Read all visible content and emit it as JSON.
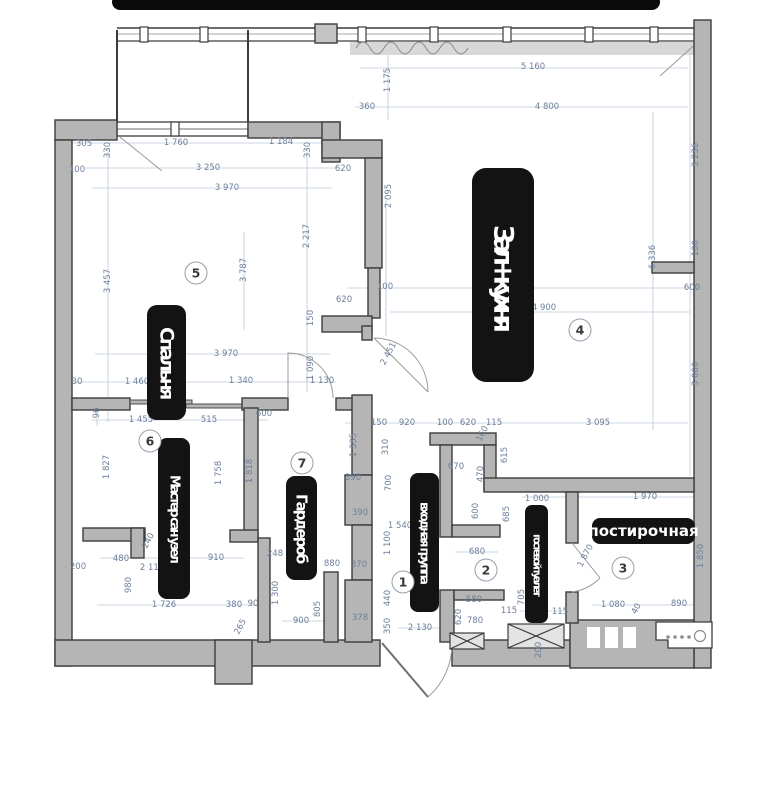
{
  "colors": {
    "wall_fill": "#b5b5b5",
    "wall_stroke": "#3c3c3c",
    "dim_text": "#6d7f9b",
    "dim_line": "#bcc6da",
    "label_bg": "#131313",
    "label_fg": "#ffffff",
    "sill_band": "#d8d8d8"
  },
  "plan": {
    "rooms": [
      {
        "number": "1",
        "name": "входная группа"
      },
      {
        "number": "2",
        "name": "гостевой туалет"
      },
      {
        "number": "3",
        "name": "постирочная"
      },
      {
        "number": "4",
        "name": "Зал + кухня"
      },
      {
        "number": "5",
        "name": "Спальня"
      },
      {
        "number": "6",
        "name": "Мастер сан узел"
      },
      {
        "number": "7",
        "name": "Гардероб"
      }
    ],
    "labels": [
      {
        "text": "Спальня",
        "x": 147,
        "y": 305,
        "w": 39,
        "h": 115,
        "vert": true,
        "size": 19,
        "ls": -3,
        "radius": 10
      },
      {
        "text": "Мастер сан узел",
        "x": 158,
        "y": 438,
        "w": 32,
        "h": 161,
        "vert": true,
        "size": 13,
        "ls": -2.5,
        "radius": 9
      },
      {
        "text": "Гардероб",
        "x": 286,
        "y": 476,
        "w": 31,
        "h": 104,
        "vert": true,
        "size": 15,
        "ls": -2,
        "radius": 9
      },
      {
        "text": "Зал + кухня",
        "x": 472,
        "y": 168,
        "w": 62,
        "h": 214,
        "vert": true,
        "size": 27,
        "ls": -8,
        "radius": 14
      },
      {
        "text": "входная группа",
        "x": 410,
        "y": 473,
        "w": 29,
        "h": 139,
        "vert": true,
        "size": 12,
        "ls": -2,
        "radius": 8
      },
      {
        "text": "гостевой туалет",
        "x": 525,
        "y": 505,
        "w": 23,
        "h": 118,
        "vert": true,
        "size": 10.5,
        "ls": -2.5,
        "radius": 7
      },
      {
        "text": "постирочная",
        "x": 592,
        "y": 518,
        "w": 103,
        "h": 26,
        "vert": false,
        "size": 15,
        "ls": 0,
        "radius": 8
      }
    ],
    "markers": [
      {
        "n": "1",
        "x": 403,
        "y": 582
      },
      {
        "n": "2",
        "x": 486,
        "y": 570
      },
      {
        "n": "3",
        "x": 623,
        "y": 568
      },
      {
        "n": "4",
        "x": 580,
        "y": 330
      },
      {
        "n": "5",
        "x": 196,
        "y": 273
      },
      {
        "n": "6",
        "x": 150,
        "y": 441
      },
      {
        "n": "7",
        "x": 302,
        "y": 463
      }
    ],
    "dimensions": [
      {
        "t": "5 160",
        "x": 533,
        "y": 67,
        "r": "h"
      },
      {
        "t": "1 175",
        "x": 388,
        "y": 80,
        "r": "v"
      },
      {
        "t": "360",
        "x": 367,
        "y": 107,
        "r": "h"
      },
      {
        "t": "4 800",
        "x": 547,
        "y": 107,
        "r": "h"
      },
      {
        "t": "3 236",
        "x": 696,
        "y": 155,
        "r": "v"
      },
      {
        "t": "305",
        "x": 84,
        "y": 144,
        "r": "h"
      },
      {
        "t": "330",
        "x": 108,
        "y": 150,
        "r": "v"
      },
      {
        "t": "1 760",
        "x": 176,
        "y": 143,
        "r": "h"
      },
      {
        "t": "1 184",
        "x": 281,
        "y": 142,
        "r": "h"
      },
      {
        "t": "330",
        "x": 308,
        "y": 150,
        "r": "v"
      },
      {
        "t": "100",
        "x": 77,
        "y": 170,
        "r": "h"
      },
      {
        "t": "3 250",
        "x": 208,
        "y": 168,
        "r": "h"
      },
      {
        "t": "620",
        "x": 343,
        "y": 169,
        "r": "h"
      },
      {
        "t": "3 970",
        "x": 227,
        "y": 188,
        "r": "h"
      },
      {
        "t": "2 095",
        "x": 389,
        "y": 196,
        "r": "v"
      },
      {
        "t": "2 217",
        "x": 307,
        "y": 236,
        "r": "v"
      },
      {
        "t": "3 457",
        "x": 108,
        "y": 281,
        "r": "v"
      },
      {
        "t": "3 787",
        "x": 244,
        "y": 270,
        "r": "v"
      },
      {
        "t": "6 336",
        "x": 653,
        "y": 257,
        "r": "v"
      },
      {
        "t": "100",
        "x": 696,
        "y": 248,
        "r": "v"
      },
      {
        "t": "600",
        "x": 692,
        "y": 288,
        "r": "h"
      },
      {
        "t": "150",
        "x": 311,
        "y": 318,
        "r": "v"
      },
      {
        "t": "620",
        "x": 344,
        "y": 300,
        "r": "h"
      },
      {
        "t": "100",
        "x": 385,
        "y": 287,
        "r": "h"
      },
      {
        "t": "2 451",
        "x": 389,
        "y": 354,
        "r": "d"
      },
      {
        "t": "4 900",
        "x": 544,
        "y": 308,
        "r": "h"
      },
      {
        "t": "3 000",
        "x": 696,
        "y": 374,
        "r": "v"
      },
      {
        "t": "3 970",
        "x": 226,
        "y": 354,
        "r": "h"
      },
      {
        "t": "30",
        "x": 77,
        "y": 382,
        "r": "h"
      },
      {
        "t": "1 460",
        "x": 137,
        "y": 382,
        "r": "h"
      },
      {
        "t": "1 340",
        "x": 241,
        "y": 381,
        "r": "h"
      },
      {
        "t": "1 130",
        "x": 322,
        "y": 381,
        "r": "h"
      },
      {
        "t": "1 090",
        "x": 311,
        "y": 368,
        "r": "v"
      },
      {
        "t": "96",
        "x": 97,
        "y": 413,
        "r": "v"
      },
      {
        "t": "1 455",
        "x": 141,
        "y": 420,
        "r": "h"
      },
      {
        "t": "515",
        "x": 209,
        "y": 420,
        "r": "h"
      },
      {
        "t": "600",
        "x": 264,
        "y": 414,
        "r": "h"
      },
      {
        "t": "150",
        "x": 379,
        "y": 423,
        "r": "h"
      },
      {
        "t": "920",
        "x": 407,
        "y": 423,
        "r": "h"
      },
      {
        "t": "100",
        "x": 445,
        "y": 423,
        "r": "h"
      },
      {
        "t": "620",
        "x": 468,
        "y": 423,
        "r": "h"
      },
      {
        "t": "115",
        "x": 494,
        "y": 423,
        "r": "h"
      },
      {
        "t": "3 095",
        "x": 598,
        "y": 423,
        "r": "h"
      },
      {
        "t": "1 335",
        "x": 354,
        "y": 445,
        "r": "v"
      },
      {
        "t": "310",
        "x": 386,
        "y": 447,
        "r": "v"
      },
      {
        "t": "160",
        "x": 483,
        "y": 434,
        "r": "d"
      },
      {
        "t": "1 827",
        "x": 107,
        "y": 467,
        "r": "v"
      },
      {
        "t": "1 758",
        "x": 219,
        "y": 473,
        "r": "v"
      },
      {
        "t": "1 818",
        "x": 250,
        "y": 471,
        "r": "v"
      },
      {
        "t": "670",
        "x": 456,
        "y": 467,
        "r": "h"
      },
      {
        "t": "470",
        "x": 481,
        "y": 474,
        "r": "v"
      },
      {
        "t": "615",
        "x": 505,
        "y": 455,
        "r": "v"
      },
      {
        "t": "685",
        "x": 507,
        "y": 514,
        "r": "v"
      },
      {
        "t": "700",
        "x": 389,
        "y": 483,
        "r": "v"
      },
      {
        "t": "390",
        "x": 353,
        "y": 478,
        "r": "h"
      },
      {
        "t": "600",
        "x": 476,
        "y": 511,
        "r": "v"
      },
      {
        "t": "1 000",
        "x": 537,
        "y": 499,
        "r": "h"
      },
      {
        "t": "1 970",
        "x": 645,
        "y": 497,
        "r": "h"
      },
      {
        "t": "390",
        "x": 360,
        "y": 513,
        "r": "h"
      },
      {
        "t": "1 540",
        "x": 400,
        "y": 526,
        "r": "h"
      },
      {
        "t": "1 100",
        "x": 388,
        "y": 543,
        "r": "v"
      },
      {
        "t": "680",
        "x": 477,
        "y": 552,
        "r": "h"
      },
      {
        "t": "1 870",
        "x": 586,
        "y": 556,
        "r": "d"
      },
      {
        "t": "1 850",
        "x": 701,
        "y": 556,
        "r": "v"
      },
      {
        "t": "370",
        "x": 359,
        "y": 565,
        "r": "h"
      },
      {
        "t": "240",
        "x": 149,
        "y": 541,
        "r": "d"
      },
      {
        "t": "480",
        "x": 121,
        "y": 559,
        "r": "h"
      },
      {
        "t": "910",
        "x": 216,
        "y": 558,
        "r": "h"
      },
      {
        "t": "2 110",
        "x": 152,
        "y": 568,
        "r": "h"
      },
      {
        "t": "200",
        "x": 78,
        "y": 567,
        "r": "h"
      },
      {
        "t": "980",
        "x": 129,
        "y": 585,
        "r": "v"
      },
      {
        "t": "248",
        "x": 275,
        "y": 554,
        "r": "h"
      },
      {
        "t": "880",
        "x": 332,
        "y": 564,
        "r": "h"
      },
      {
        "t": "1 726",
        "x": 164,
        "y": 605,
        "r": "h"
      },
      {
        "t": "380",
        "x": 234,
        "y": 605,
        "r": "h"
      },
      {
        "t": "90",
        "x": 253,
        "y": 604,
        "r": "h"
      },
      {
        "t": "265",
        "x": 241,
        "y": 627,
        "r": "d"
      },
      {
        "t": "1 300",
        "x": 276,
        "y": 593,
        "r": "v"
      },
      {
        "t": "805",
        "x": 318,
        "y": 609,
        "r": "v"
      },
      {
        "t": "900",
        "x": 301,
        "y": 621,
        "r": "h"
      },
      {
        "t": "378",
        "x": 360,
        "y": 618,
        "r": "h"
      },
      {
        "t": "440",
        "x": 388,
        "y": 598,
        "r": "v"
      },
      {
        "t": "350",
        "x": 388,
        "y": 626,
        "r": "v"
      },
      {
        "t": "2 130",
        "x": 420,
        "y": 628,
        "r": "h"
      },
      {
        "t": "580",
        "x": 474,
        "y": 600,
        "r": "h"
      },
      {
        "t": "620",
        "x": 459,
        "y": 617,
        "r": "v"
      },
      {
        "t": "780",
        "x": 475,
        "y": 621,
        "r": "h"
      },
      {
        "t": "115",
        "x": 509,
        "y": 611,
        "r": "h"
      },
      {
        "t": "115",
        "x": 560,
        "y": 612,
        "r": "h"
      },
      {
        "t": "705",
        "x": 522,
        "y": 597,
        "r": "v"
      },
      {
        "t": "1 080",
        "x": 613,
        "y": 605,
        "r": "h"
      },
      {
        "t": "40",
        "x": 637,
        "y": 609,
        "r": "d"
      },
      {
        "t": "890",
        "x": 679,
        "y": 604,
        "r": "h"
      },
      {
        "t": "200",
        "x": 539,
        "y": 650,
        "r": "v"
      }
    ]
  }
}
